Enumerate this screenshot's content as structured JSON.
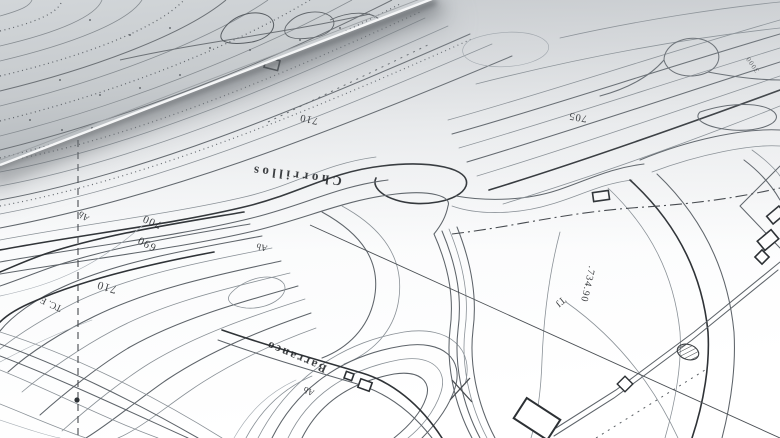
{
  "labels": {
    "chorrillos": {
      "text": "Chorrillos"
    },
    "barranco": {
      "text": "Barranco"
    },
    "elev_700": {
      "text": "700"
    },
    "elev_690": {
      "text": "690"
    },
    "elev_710_left": {
      "text": "710"
    },
    "elev_710_upper": {
      "text": "710"
    },
    "elev_705": {
      "text": "705"
    },
    "spot_height": {
      "text": ".734.90"
    },
    "tj": {
      "text": "TJ"
    },
    "tcf": {
      "text": "TC. F"
    },
    "ab_left": {
      "text": "Ab"
    },
    "ab_center": {
      "text": "Ab"
    },
    "ab_bottom": {
      "text": "Ab"
    },
    "small_3000": {
      "text": "3000"
    }
  },
  "palette": {
    "paper": "#fdfdfd",
    "ink": "#2f3337",
    "light_ink": "#8a9197",
    "curl_gray": "#c3c7ca",
    "shadow": "#5a5f64"
  },
  "symbols": {
    "building": "building-rectangle",
    "cross": "x-survey-mark",
    "hatched_circle": "hatched-circle",
    "survey_dot": "survey-point-dot",
    "diamond": "road-junction-diamond"
  }
}
